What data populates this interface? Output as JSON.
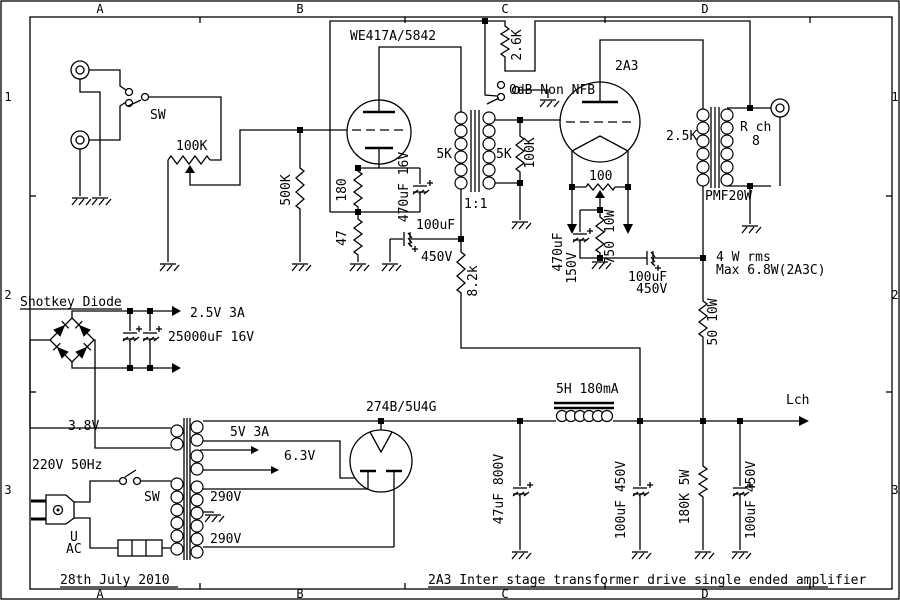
{
  "frame": {
    "grid_columns": [
      "A",
      "B",
      "C",
      "D"
    ],
    "grid_rows": [
      "1",
      "2",
      "3"
    ],
    "date": "28th July 2010",
    "title": "2A3 Inter stage transformer drive single ended amplifier"
  },
  "colors": {
    "ink": "#000000",
    "paper": "#ffffff"
  },
  "labels": {
    "we417a": "WE417A/5842",
    "fb_resistor": "2.6K",
    "fb_switch": "0dB Non NFB",
    "tube_2a3": "2A3",
    "opt_primary": "2.5K",
    "out_channel": "R ch",
    "out_impedance": "8",
    "opt_model": "PMF20W",
    "input_switch": "SW",
    "volume_pot": "100K",
    "grid_r1": "500K",
    "cathode_r1": "180",
    "cathode_c1": "470uF 16V",
    "cathode_r2": "47",
    "decouple_c1_value": "100uF",
    "decouple_c1_voltage": "450V",
    "drop_r": "8.2k",
    "it_primary": "5K",
    "it_secondary": "5K",
    "it_ratio": "1:1",
    "grid_r2": "100K",
    "hum_pot": "100",
    "cathode_r3": "750 10W",
    "cathode_c3_value": "470uF",
    "cathode_c3_voltage": "150V",
    "decouple_c2_value": "100uF",
    "decouple_c2_voltage": "450V",
    "power_line1": "4 W rms",
    "power_line2": "Max 6.8W(2A3C)",
    "decouple_r2": "50 10W",
    "rectifier_label": "Shotkey Diode",
    "filament_supply": "2.5V 3A",
    "filament_cap": "25000uF 16V",
    "winding_38": "3.8V",
    "winding_5": "5V 3A",
    "winding_63": "6.3V",
    "mains": "220V 50Hz",
    "mains_switch": "SW",
    "winding_290a": "290V",
    "winding_290b": "290V",
    "plug_line1": "U",
    "plug_line2": "AC",
    "rect_tube": "274B/5U4G",
    "choke": "5H 180mA",
    "filter_c1": "47uF 800V",
    "filter_c2": "100uF 450V",
    "bleeder_r": "180K 5W",
    "filter_c3": "100uF 450V",
    "out_left": "Lch"
  }
}
